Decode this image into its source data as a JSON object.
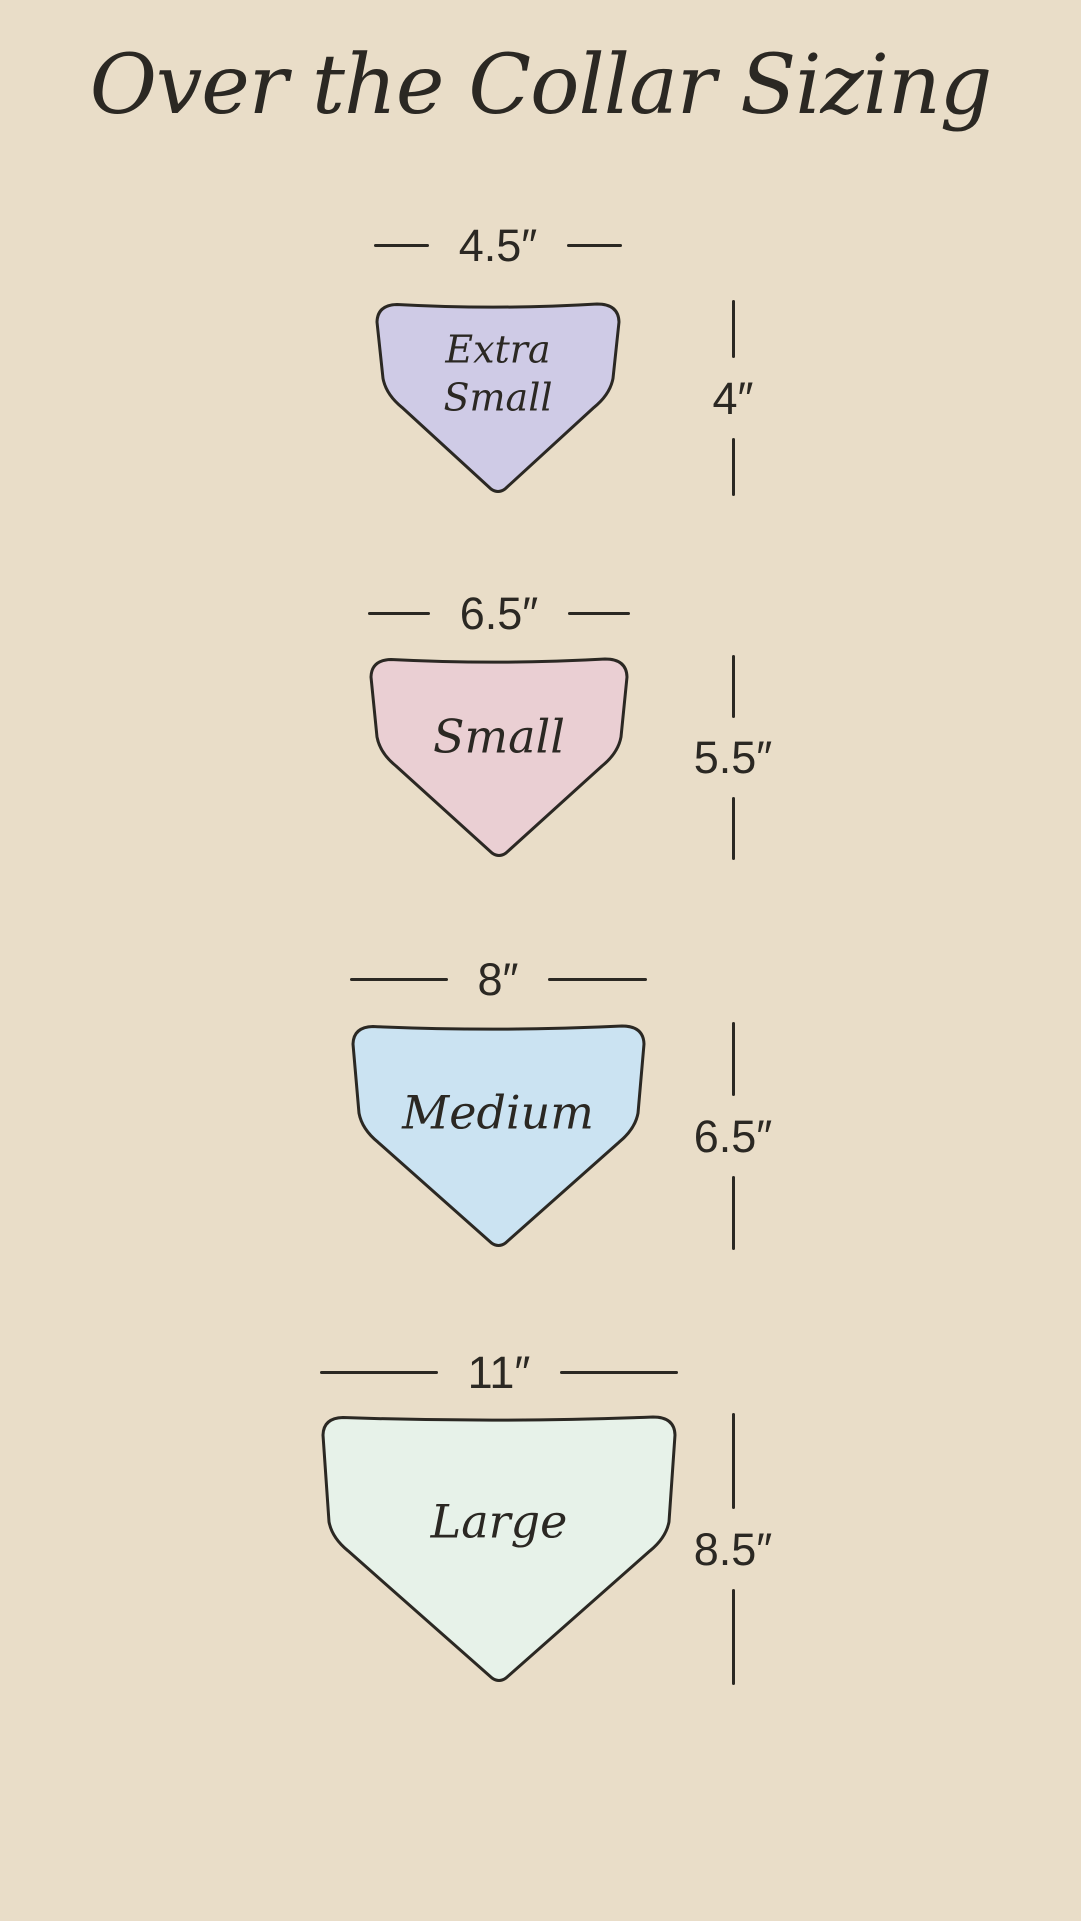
{
  "title": "Over the Collar Sizing",
  "colors": {
    "background": "#e9ddc8",
    "line": "#2b2823",
    "text": "#2b2823"
  },
  "sizes": [
    {
      "id": "extra-small",
      "name": "Extra Small",
      "name_lines": [
        "Extra",
        "Small"
      ],
      "width_label": "4.5″",
      "height_label": "4″",
      "fill": "#cfcbe6"
    },
    {
      "id": "small",
      "name": "Small",
      "name_lines": [
        "Small"
      ],
      "width_label": "6.5″",
      "height_label": "5.5″",
      "fill": "#eacfd3"
    },
    {
      "id": "medium",
      "name": "Medium",
      "name_lines": [
        "Medium"
      ],
      "width_label": "8″",
      "height_label": "6.5″",
      "fill": "#cbe3f2"
    },
    {
      "id": "large",
      "name": "Large",
      "name_lines": [
        "Large"
      ],
      "width_label": "11″",
      "height_label": "8.5″",
      "fill": "#e7f2e9"
    }
  ]
}
